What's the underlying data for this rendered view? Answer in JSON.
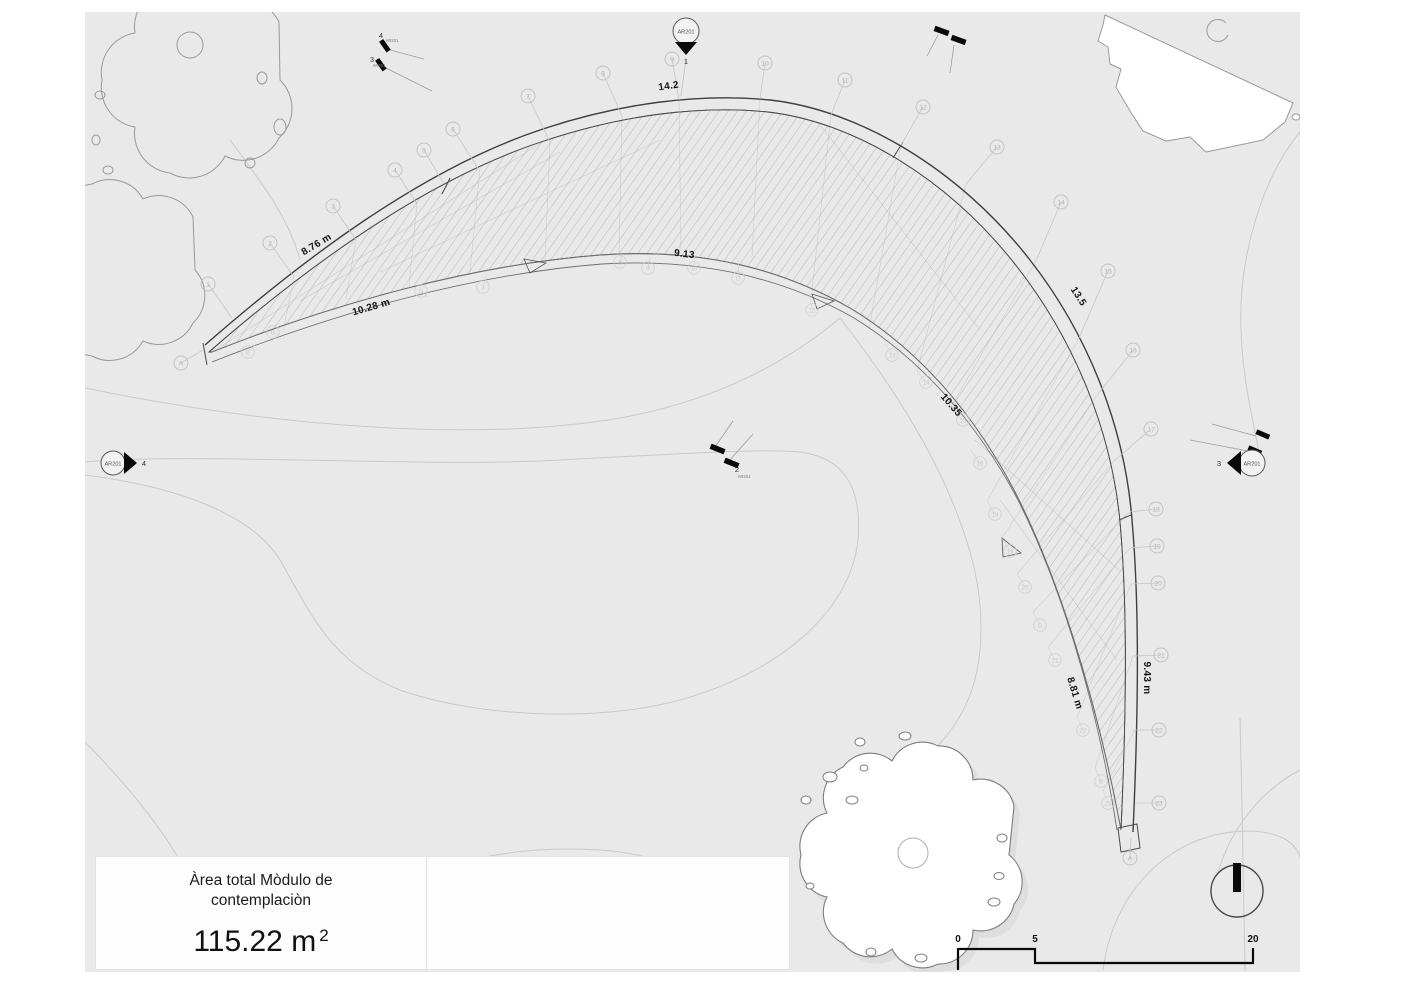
{
  "title_block": {
    "line1": "Àrea total Mòdulo de",
    "line2": "contemplaciòn",
    "area_value": "115.22 m",
    "area_sup": "2"
  },
  "scale_bar": {
    "labels": [
      "0",
      "5",
      "20"
    ]
  },
  "markers": {
    "top_balloon": {
      "ref": "AR201",
      "num": "1"
    },
    "left_balloon": {
      "ref": "AR201",
      "num": "4"
    },
    "right_balloon": {
      "ref": "AR201",
      "num": "3"
    },
    "center_cut": {
      "ref": "AR201",
      "num": "2"
    },
    "topleft_cut_a": {
      "ref": "AR201",
      "num": "4"
    },
    "topleft_cut_b": {
      "ref": "AR201",
      "num": "3"
    }
  },
  "plan": {
    "dimensions": [
      {
        "text": "14.2",
        "x": 669,
        "y": 89,
        "rot": -8
      },
      {
        "text": "8.76 m",
        "x": 318,
        "y": 247,
        "rot": -31
      },
      {
        "text": "10.28 m",
        "x": 372,
        "y": 310,
        "rot": -16
      },
      {
        "text": "9.13",
        "x": 684,
        "y": 257,
        "rot": 7
      },
      {
        "text": "13.5",
        "x": 1076,
        "y": 298,
        "rot": 57
      },
      {
        "text": "10.35",
        "x": 949,
        "y": 407,
        "rot": 49
      },
      {
        "text": "8.81 m",
        "x": 1072,
        "y": 694,
        "rot": 73
      },
      {
        "text": "9.43 m",
        "x": 1144,
        "y": 678,
        "rot": 90
      }
    ],
    "grid_bubbles_outer": [
      {
        "label": "A",
        "x": 181,
        "y": 363,
        "tx": 203,
        "ty": 350
      },
      {
        "label": "1",
        "x": 208,
        "y": 284,
        "tx": 232,
        "ty": 318
      },
      {
        "label": "2",
        "x": 270,
        "y": 243,
        "tx": 294,
        "ty": 277
      },
      {
        "label": "3",
        "x": 333,
        "y": 206,
        "tx": 356,
        "ty": 240
      },
      {
        "label": "4",
        "x": 395,
        "y": 170,
        "tx": 417,
        "ty": 204
      },
      {
        "label": "5",
        "x": 424,
        "y": 150,
        "tx": 444,
        "ty": 184
      },
      {
        "label": "6",
        "x": 453,
        "y": 129,
        "tx": 478,
        "ty": 168
      },
      {
        "label": "7",
        "x": 528,
        "y": 96,
        "tx": 550,
        "ty": 142
      },
      {
        "label": "8",
        "x": 603,
        "y": 73,
        "tx": 622,
        "ty": 116
      },
      {
        "label": "9",
        "x": 672,
        "y": 59,
        "tx": 679,
        "ty": 100
      },
      {
        "label": "10",
        "x": 765,
        "y": 63,
        "tx": 760,
        "ty": 99
      },
      {
        "label": "11",
        "x": 845,
        "y": 80,
        "tx": 831,
        "ty": 115
      },
      {
        "label": "12",
        "x": 923,
        "y": 107,
        "tx": 901,
        "ty": 145
      },
      {
        "label": "13",
        "x": 997,
        "y": 147,
        "tx": 966,
        "ty": 184
      },
      {
        "label": "14",
        "x": 1061,
        "y": 202,
        "tx": 1036,
        "ty": 261
      },
      {
        "label": "15",
        "x": 1108,
        "y": 271,
        "tx": 1079,
        "ty": 338
      },
      {
        "label": "16",
        "x": 1133,
        "y": 350,
        "tx": 1098,
        "ty": 394
      },
      {
        "label": "17",
        "x": 1151,
        "y": 429,
        "tx": 1114,
        "ty": 461
      },
      {
        "label": "18",
        "x": 1156,
        "y": 509,
        "tx": 1129,
        "ty": 512
      },
      {
        "label": "19",
        "x": 1157,
        "y": 546,
        "tx": 1130,
        "ty": 548
      },
      {
        "label": "20",
        "x": 1158,
        "y": 583,
        "tx": 1131,
        "ty": 584
      },
      {
        "label": "21",
        "x": 1161,
        "y": 655,
        "tx": 1133,
        "ty": 656
      },
      {
        "label": "22",
        "x": 1159,
        "y": 730,
        "tx": 1135,
        "ty": 730
      },
      {
        "label": "23",
        "x": 1159,
        "y": 803,
        "tx": 1135,
        "ty": 803
      },
      {
        "label": "A",
        "x": 1130,
        "y": 858,
        "tx": 1131,
        "ty": 838
      }
    ],
    "grid_bubbles_inner": [
      {
        "label": "E",
        "x": 248,
        "y": 352,
        "tx": 256,
        "ty": 344
      },
      {
        "label": "B",
        "x": 273,
        "y": 332,
        "tx": 281,
        "ty": 339
      },
      {
        "label": "D",
        "x": 421,
        "y": 291,
        "tx": 428,
        "ty": 297
      },
      {
        "label": "3",
        "x": 483,
        "y": 287,
        "tx": 487,
        "ty": 276
      },
      {
        "label": "8",
        "x": 620,
        "y": 262,
        "tx": 622,
        "ty": 255
      },
      {
        "label": "9",
        "x": 648,
        "y": 268,
        "tx": 650,
        "ty": 257
      },
      {
        "label": "10",
        "x": 694,
        "y": 268,
        "tx": 695,
        "ty": 253
      },
      {
        "label": "11",
        "x": 738,
        "y": 278,
        "tx": 739,
        "ty": 258
      },
      {
        "label": "12",
        "x": 812,
        "y": 310,
        "tx": 809,
        "ty": 291
      },
      {
        "label": "13",
        "x": 892,
        "y": 355,
        "tx": 884,
        "ty": 341
      },
      {
        "label": "14",
        "x": 926,
        "y": 382,
        "tx": 917,
        "ty": 371
      },
      {
        "label": "15",
        "x": 963,
        "y": 420,
        "tx": 951,
        "ty": 407
      },
      {
        "label": "16",
        "x": 980,
        "y": 463,
        "tx": 970,
        "ty": 449
      },
      {
        "label": "18",
        "x": 995,
        "y": 514,
        "tx": 987,
        "ty": 501
      },
      {
        "label": "19",
        "x": 1010,
        "y": 551,
        "tx": 1002,
        "ty": 538
      },
      {
        "label": "20",
        "x": 1025,
        "y": 587,
        "tx": 1017,
        "ty": 574
      },
      {
        "label": "D",
        "x": 1040,
        "y": 625,
        "tx": 1033,
        "ty": 612
      },
      {
        "label": "21",
        "x": 1055,
        "y": 660,
        "tx": 1048,
        "ty": 647
      },
      {
        "label": "22",
        "x": 1083,
        "y": 730,
        "tx": 1077,
        "ty": 717
      },
      {
        "label": "B",
        "x": 1101,
        "y": 781,
        "tx": 1095,
        "ty": 768
      },
      {
        "label": "23",
        "x": 1108,
        "y": 803,
        "tx": 1103,
        "ty": 791
      }
    ]
  },
  "colors": {
    "canvas": "#e9e9e9",
    "contour": "#c9c9c9",
    "structure_stroke": "#3f3f3f",
    "hatch": "#8f8f8f",
    "black": "#0a0a0a"
  }
}
